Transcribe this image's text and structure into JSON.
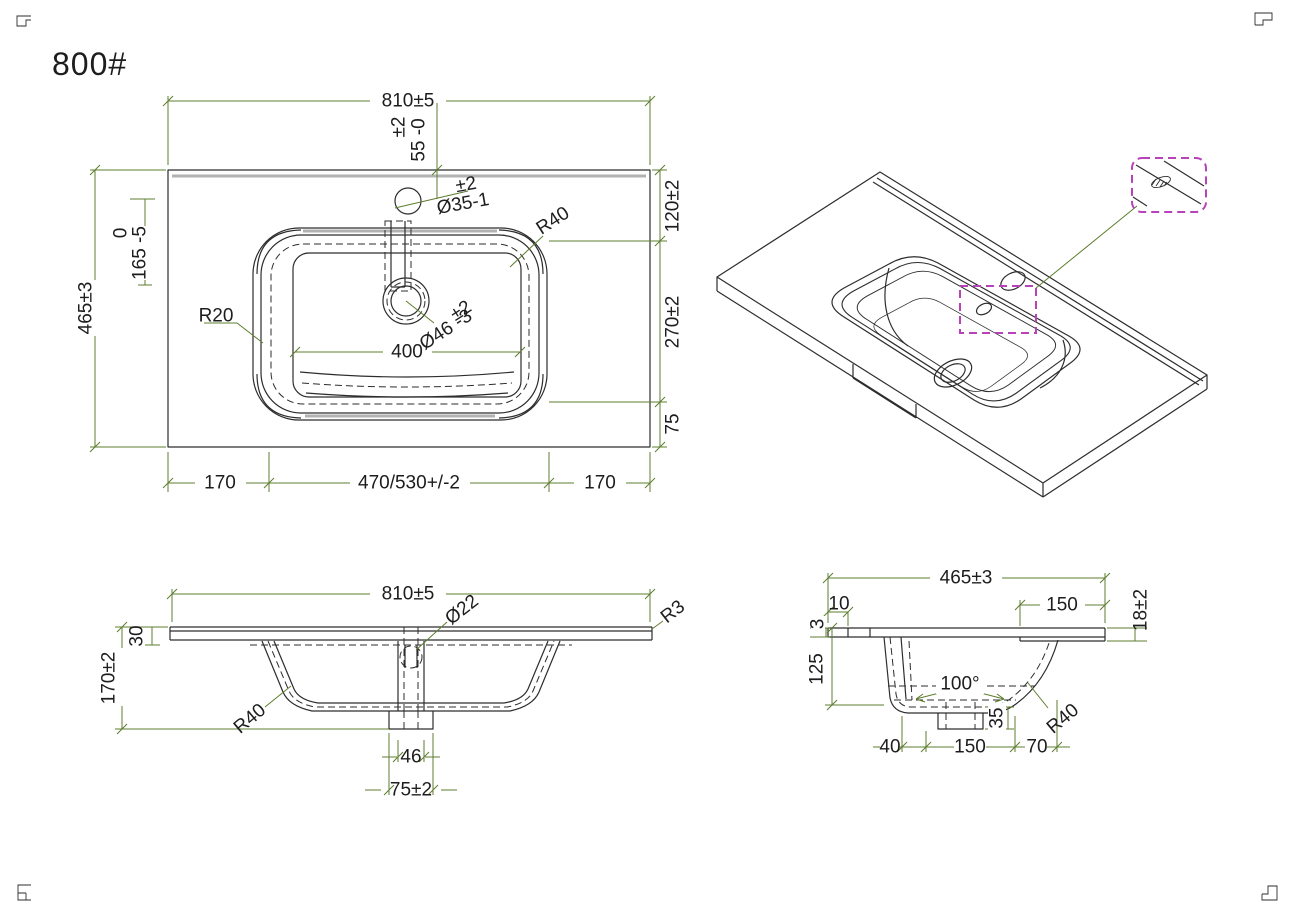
{
  "title": "800#",
  "colors": {
    "dimension_line": "#5d7d2e",
    "drawing_line": "#2d2d2d",
    "highlight_box": "#b843b8"
  },
  "plan": {
    "width": "810±5",
    "faucet_tol": "±2",
    "faucet_offset": "55 -0",
    "hole_tol": "±2",
    "hole_dia": "Ø35-1",
    "r40": "R40",
    "r20": "R20",
    "drain_tol": "±2",
    "drain_dia": "Ø46 -3",
    "basin_width": "400",
    "height": "465±3",
    "rim_tol": "0",
    "rim_offset": "165 -5",
    "right_top": "120±2",
    "right_mid": "270±2",
    "right_bot": "75",
    "bot_left": "170",
    "bot_mid": "470/530+/-2",
    "bot_right": "170"
  },
  "front": {
    "width": "810±5",
    "pipe": "Ø22",
    "edge_r": "R3",
    "lip": "30",
    "height": "170±2",
    "r40": "R40",
    "drain_inner": "46",
    "drain_outer": "75±2"
  },
  "side": {
    "depth": "465±3",
    "back_lip": "10",
    "edge": "3",
    "front_flat": "150",
    "edge_thick": "18±2",
    "bowl_depth": "125",
    "angle": "100°",
    "boss": "35",
    "r40": "R40",
    "b1": "40",
    "b2": "150",
    "b3": "70"
  }
}
